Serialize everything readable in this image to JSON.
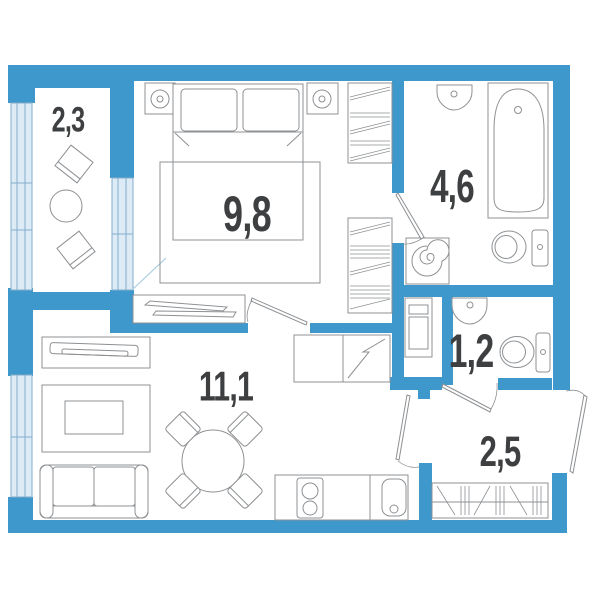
{
  "plan": {
    "type": "apartment-floor-plan",
    "wall_color": "#3E98CC",
    "glazing_color": "#DCEBF6",
    "glazing_stroke": "#85AECB",
    "furniture_stroke": "#8D9093",
    "label_color": "#3D3F41",
    "rooms": [
      {
        "name": "balcony",
        "area": "2,3",
        "furniture": [
          "chair",
          "round-table",
          "chair"
        ]
      },
      {
        "name": "bedroom",
        "area": "9,8",
        "furniture": [
          "nightstand",
          "table-lamp",
          "double-bed",
          "nightstand",
          "table-lamp",
          "wardrobe",
          "wardrobe",
          "sliding-wardrobe",
          "rug"
        ]
      },
      {
        "name": "bathroom",
        "area": "4,6",
        "furniture": [
          "washbasin",
          "bathtub",
          "toilet",
          "washing-machine"
        ]
      },
      {
        "name": "wc",
        "area": "1,2",
        "furniture": [
          "washbasin",
          "toilet",
          "utility-cabinet"
        ]
      },
      {
        "name": "living-kitchen",
        "area": "11,1",
        "furniture": [
          "tv-stand",
          "tv",
          "rug",
          "coffee-table",
          "sofa",
          "dining-table",
          "chair",
          "chair",
          "chair",
          "chair",
          "refrigerator",
          "kitchen-counter",
          "stove",
          "kitchen-sink"
        ]
      },
      {
        "name": "hallway",
        "area": "2,5",
        "furniture": [
          "shoe-wardrobe",
          "entrance-door"
        ]
      }
    ]
  }
}
